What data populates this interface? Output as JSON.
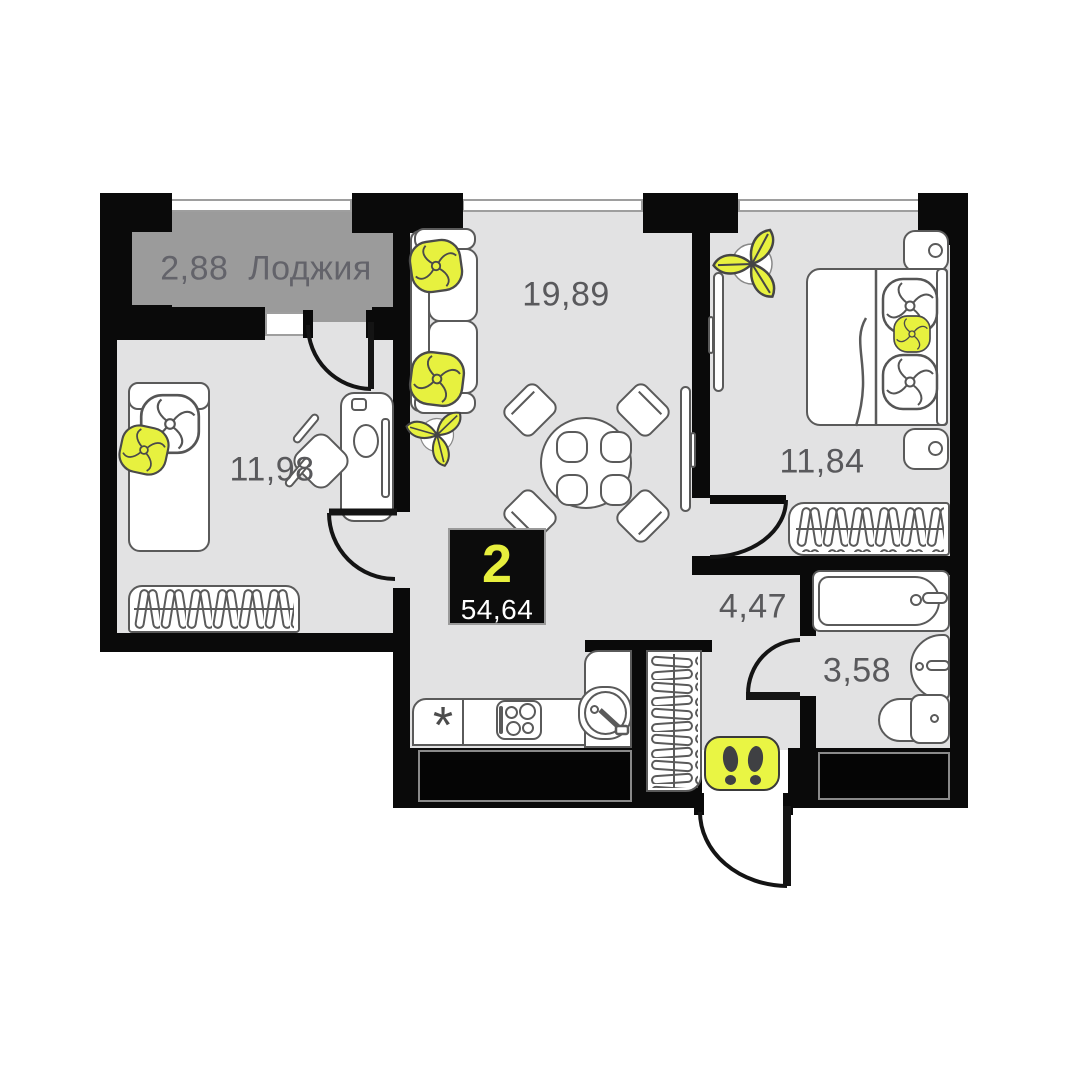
{
  "unit": {
    "rooms_count": "2",
    "total_area": "54,64"
  },
  "rooms": {
    "loggia": {
      "area": "2,88",
      "name": "Лоджия"
    },
    "living": {
      "area": "19,89"
    },
    "bedroom_left": {
      "area": "11,98"
    },
    "bedroom_right": {
      "area": "11,84"
    },
    "hallway": {
      "area": "4,47"
    },
    "bathroom": {
      "area": "3,58"
    }
  },
  "symbols": {
    "fridge": "*"
  },
  "colors": {
    "wall": "#0a0a0a",
    "floor": "#e2e2e3",
    "loggia_floor": "#9b9b9b",
    "accent_yellow": "#e7f13f",
    "badge_bg": "#0c0c0c",
    "badge_number": "#e7ef3d",
    "label_text": "#59595c"
  }
}
